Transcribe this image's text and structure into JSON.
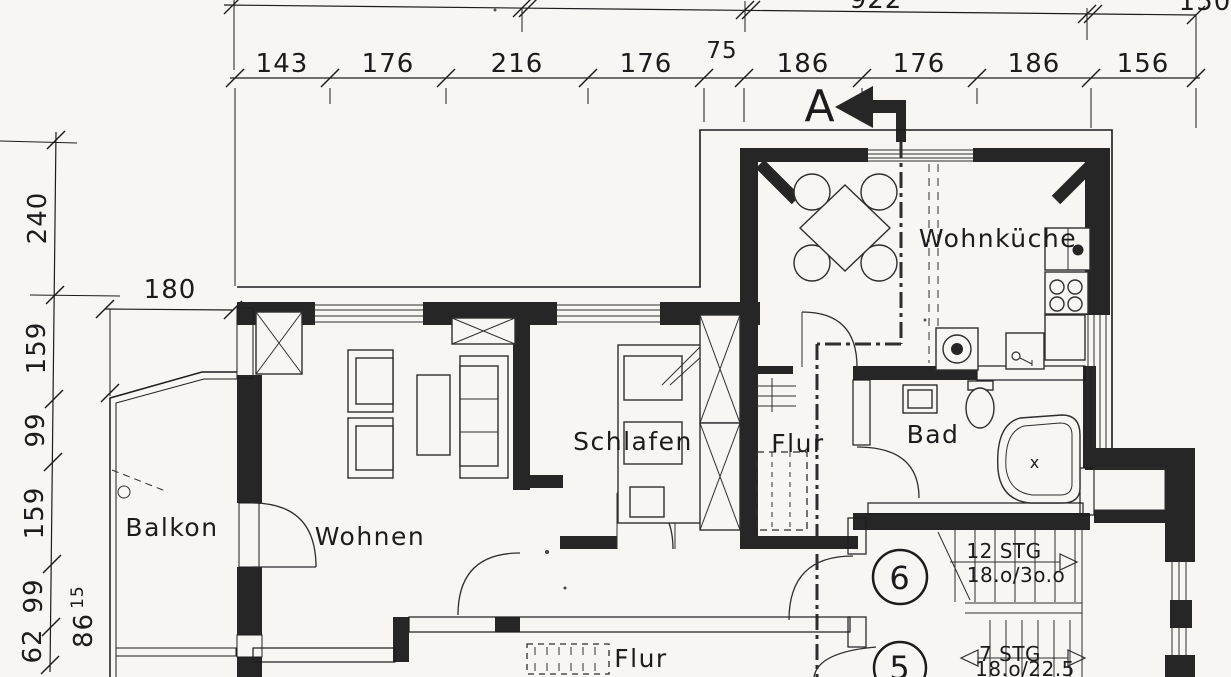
{
  "colors": {
    "paper": "#f7f6f3",
    "ink": "#1c1c1c"
  },
  "dimension_chains": {
    "top_partial": {
      "values": [
        "922",
        "150"
      ]
    },
    "top_main": {
      "values": [
        "143",
        "176",
        "216",
        "176",
        "75",
        "186",
        "176",
        "186",
        "156"
      ]
    },
    "left": {
      "values": [
        "240",
        "159",
        "99",
        "159",
        "99",
        "62"
      ],
      "bottom_value": "86",
      "bottom_sup": "15"
    },
    "detail": {
      "value": "180"
    }
  },
  "section_marker": {
    "label": "A"
  },
  "rooms": {
    "wohnkueche": "Wohnküche",
    "schlafen": "Schlafen",
    "flur_upper": "Flur",
    "bad": "Bad",
    "balkon": "Balkon",
    "wohnen": "Wohnen",
    "flur_lower": "Flur"
  },
  "stairs": {
    "upper_line1": "12 STG",
    "upper_line2": "18.o/3o.o",
    "lower_line1": "7 STG",
    "lower_line2": "18.o/22.5"
  },
  "unit_numbers": {
    "circle_top": "6",
    "circle_bottom": "5"
  },
  "marks": {
    "bathtub_cross": "x"
  }
}
